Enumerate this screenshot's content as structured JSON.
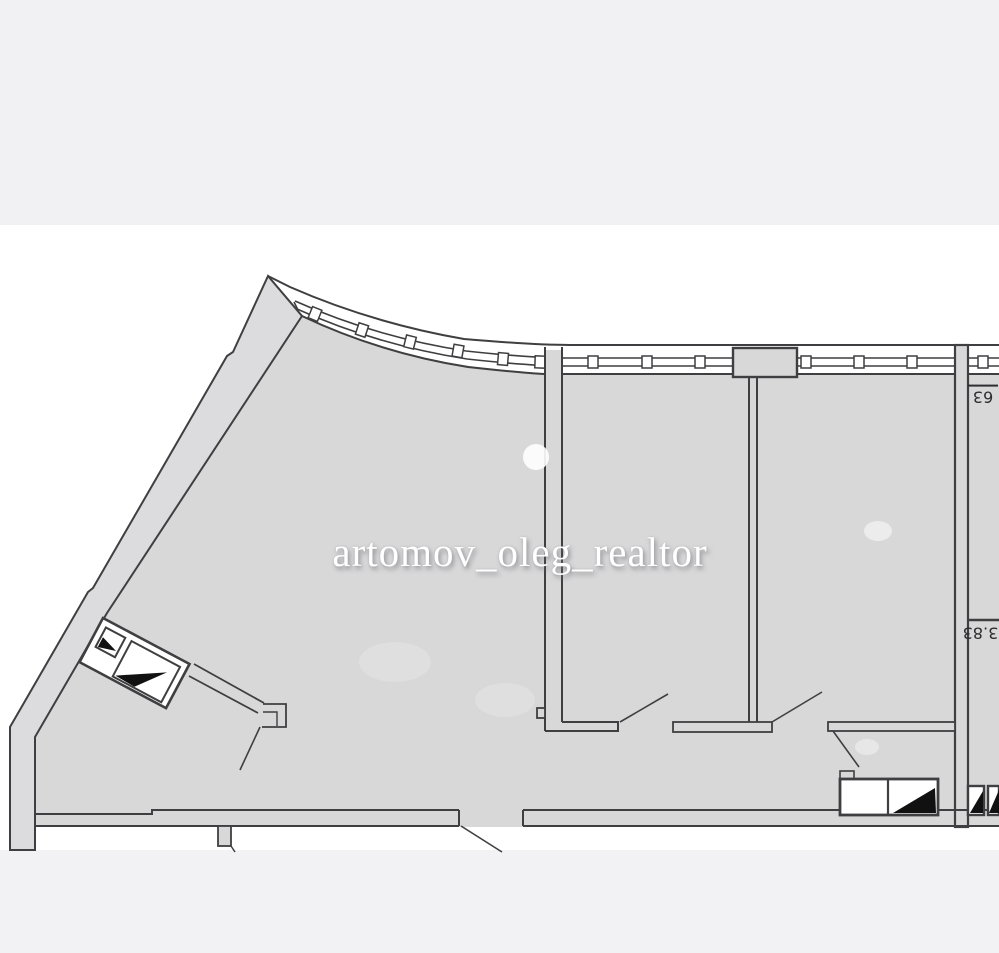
{
  "page": {
    "background_color": "#ffffff",
    "top_band_color": "#f1f1f3",
    "footer_band_color": "#f2f2f4"
  },
  "watermark": {
    "text": "artomov_oleg_realtor",
    "color": "#ffffff"
  },
  "plan": {
    "type": "apartment-floor-plan",
    "room_fill_color": "#d8d8d9",
    "wall_band_color": "#dcdcde",
    "line_color": "#3f3f41",
    "duct_triangle_color": "#111111",
    "dimensions": [
      {
        "value": "63",
        "orientation": "rotated-180"
      },
      {
        "value": "3.83",
        "orientation": "rotated-180"
      }
    ]
  }
}
